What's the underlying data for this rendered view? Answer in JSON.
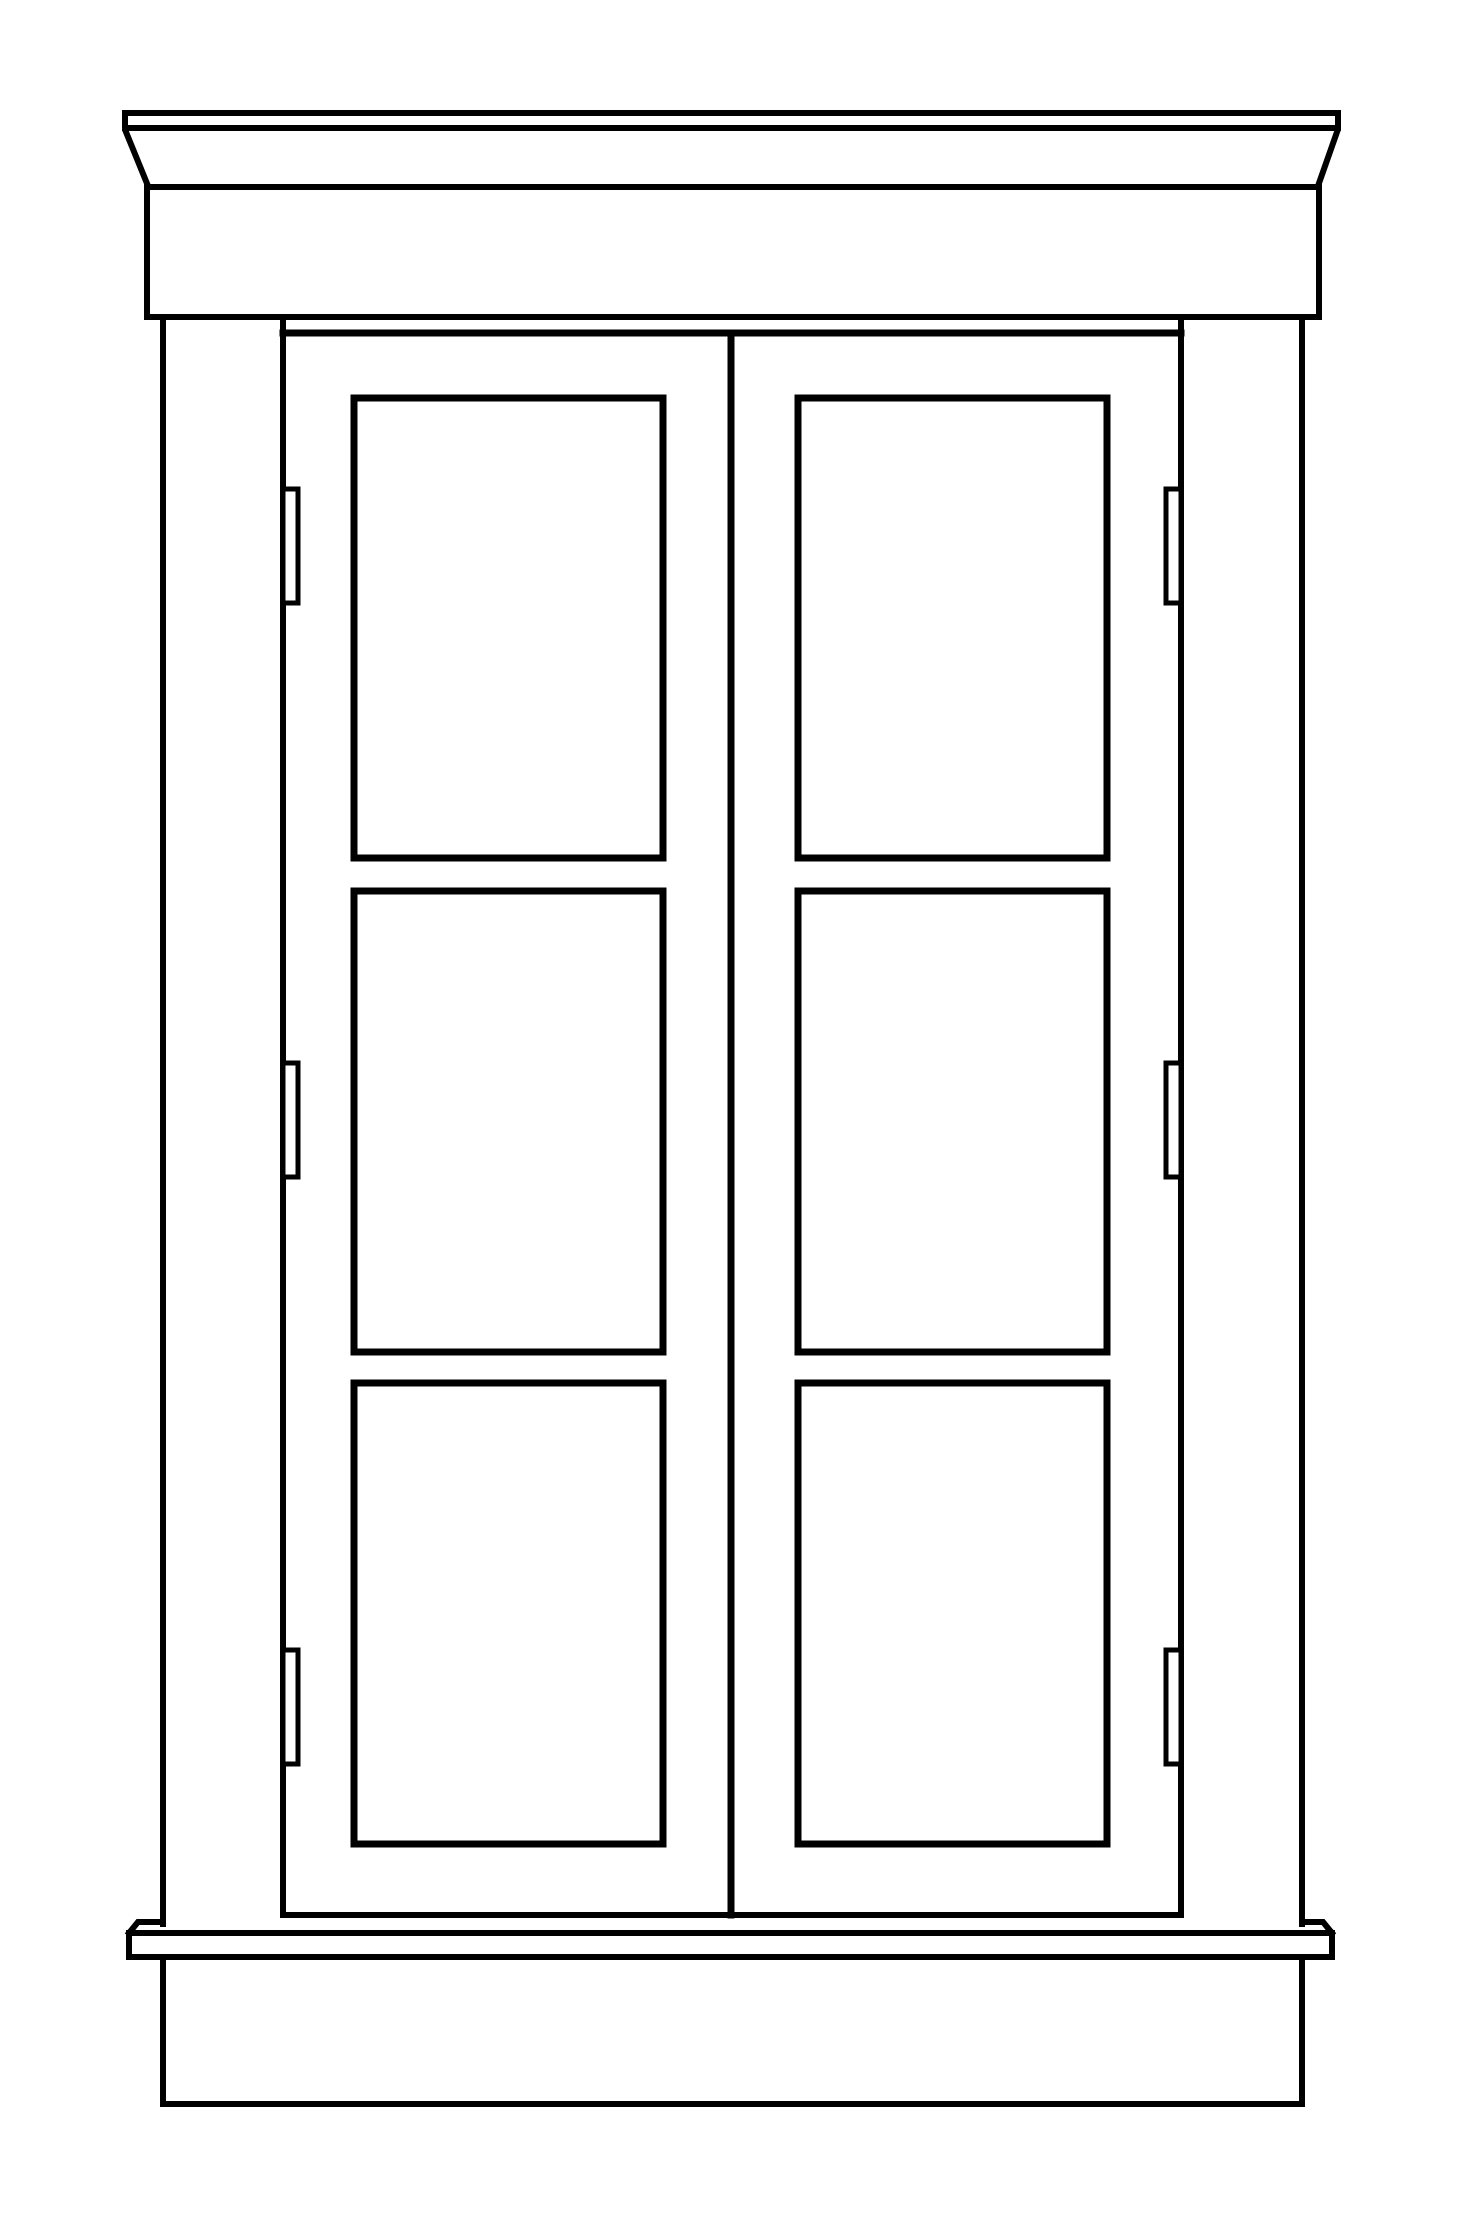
{
  "canvas": {
    "width": 1459,
    "height": 2229,
    "background_color": "#ffffff"
  },
  "drawing": {
    "subject": "cabinet-elevation-line-drawing",
    "line_color": "#000000",
    "default_stroke_width": 6,
    "shapes": [
      {
        "name": "crown-cap-board",
        "type": "rect",
        "x": 125,
        "y": 113,
        "w": 1213,
        "h": 15,
        "sw": 6,
        "fill": "#ffffff"
      },
      {
        "name": "crown-left-slant",
        "type": "line",
        "x1": 126,
        "y1": 132,
        "x2": 148,
        "y2": 186,
        "sw": 6
      },
      {
        "name": "crown-right-slant",
        "type": "line",
        "x1": 1337,
        "y1": 132,
        "x2": 1318,
        "y2": 186,
        "sw": 6
      },
      {
        "name": "crown-bottom-edge",
        "type": "line",
        "x1": 147,
        "y1": 187,
        "x2": 1319,
        "y2": 187,
        "sw": 6
      },
      {
        "name": "frieze-left-edge",
        "type": "line",
        "x1": 147,
        "y1": 187,
        "x2": 147,
        "y2": 317,
        "sw": 6
      },
      {
        "name": "frieze-right-edge",
        "type": "line",
        "x1": 1319,
        "y1": 187,
        "x2": 1319,
        "y2": 317,
        "sw": 6
      },
      {
        "name": "frieze-bottom-edge",
        "type": "line",
        "x1": 147,
        "y1": 317,
        "x2": 1319,
        "y2": 317,
        "sw": 6
      },
      {
        "name": "left-stile-outer-edge",
        "type": "line",
        "x1": 163,
        "y1": 317,
        "x2": 163,
        "y2": 1924,
        "sw": 6
      },
      {
        "name": "left-stile-inner-edge",
        "type": "line",
        "x1": 283,
        "y1": 317,
        "x2": 283,
        "y2": 1915,
        "sw": 6
      },
      {
        "name": "right-stile-inner-edge",
        "type": "line",
        "x1": 1181,
        "y1": 317,
        "x2": 1181,
        "y2": 1915,
        "sw": 6
      },
      {
        "name": "right-stile-outer-edge",
        "type": "line",
        "x1": 1302,
        "y1": 317,
        "x2": 1302,
        "y2": 1924,
        "sw": 6
      },
      {
        "name": "door-top-edge",
        "type": "line",
        "x1": 283,
        "y1": 333,
        "x2": 1181,
        "y2": 333,
        "sw": 7
      },
      {
        "name": "door-meeting-stile",
        "type": "line",
        "x1": 731,
        "y1": 333,
        "x2": 731,
        "y2": 1915,
        "sw": 7
      },
      {
        "name": "door-bottom-edge",
        "type": "line",
        "x1": 283,
        "y1": 1915,
        "x2": 1181,
        "y2": 1915,
        "sw": 6
      },
      {
        "name": "left-door-top-panel",
        "type": "rect",
        "x": 354,
        "y": 398,
        "w": 309,
        "h": 460,
        "sw": 7,
        "fill": "#ffffff"
      },
      {
        "name": "left-door-middle-panel",
        "type": "rect",
        "x": 354,
        "y": 891,
        "w": 309,
        "h": 461,
        "sw": 7,
        "fill": "#ffffff"
      },
      {
        "name": "left-door-bottom-panel",
        "type": "rect",
        "x": 354,
        "y": 1383,
        "w": 309,
        "h": 461,
        "sw": 7,
        "fill": "#ffffff"
      },
      {
        "name": "right-door-top-panel",
        "type": "rect",
        "x": 798,
        "y": 398,
        "w": 309,
        "h": 460,
        "sw": 7,
        "fill": "#ffffff"
      },
      {
        "name": "right-door-middle-panel",
        "type": "rect",
        "x": 798,
        "y": 891,
        "w": 309,
        "h": 461,
        "sw": 7,
        "fill": "#ffffff"
      },
      {
        "name": "right-door-bottom-panel",
        "type": "rect",
        "x": 798,
        "y": 1383,
        "w": 309,
        "h": 461,
        "sw": 7,
        "fill": "#ffffff"
      },
      {
        "name": "left-top-hinge",
        "type": "rect",
        "x": 283,
        "y": 489,
        "w": 15,
        "h": 114,
        "sw": 5,
        "fill": "#ffffff"
      },
      {
        "name": "left-middle-hinge",
        "type": "rect",
        "x": 283,
        "y": 1063,
        "w": 15,
        "h": 114,
        "sw": 5,
        "fill": "#ffffff"
      },
      {
        "name": "left-bottom-hinge",
        "type": "rect",
        "x": 283,
        "y": 1650,
        "w": 15,
        "h": 114,
        "sw": 5,
        "fill": "#ffffff"
      },
      {
        "name": "right-top-hinge",
        "type": "rect",
        "x": 1166,
        "y": 489,
        "w": 15,
        "h": 114,
        "sw": 5,
        "fill": "#ffffff"
      },
      {
        "name": "right-middle-hinge",
        "type": "rect",
        "x": 1166,
        "y": 1063,
        "w": 15,
        "h": 114,
        "sw": 5,
        "fill": "#ffffff"
      },
      {
        "name": "right-bottom-hinge",
        "type": "rect",
        "x": 1166,
        "y": 1650,
        "w": 15,
        "h": 114,
        "sw": 5,
        "fill": "#ffffff"
      },
      {
        "name": "sill-left-horn",
        "type": "path",
        "d": "M 163 1922 L 138 1922 L 129 1933",
        "sw": 6
      },
      {
        "name": "sill-right-horn",
        "type": "path",
        "d": "M 1302 1922 L 1323 1922 L 1332 1933",
        "sw": 6
      },
      {
        "name": "sill-top-edge",
        "type": "line",
        "x1": 129,
        "y1": 1933,
        "x2": 1332,
        "y2": 1933,
        "sw": 6
      },
      {
        "name": "sill-left-end",
        "type": "line",
        "x1": 129,
        "y1": 1933,
        "x2": 129,
        "y2": 1957,
        "sw": 6
      },
      {
        "name": "sill-right-end",
        "type": "line",
        "x1": 1332,
        "y1": 1933,
        "x2": 1332,
        "y2": 1957,
        "sw": 6
      },
      {
        "name": "sill-bottom-edge",
        "type": "line",
        "x1": 129,
        "y1": 1957,
        "x2": 1332,
        "y2": 1957,
        "sw": 6
      },
      {
        "name": "base-left-edge",
        "type": "line",
        "x1": 163,
        "y1": 1957,
        "x2": 163,
        "y2": 2104,
        "sw": 6
      },
      {
        "name": "base-right-edge",
        "type": "line",
        "x1": 1302,
        "y1": 1957,
        "x2": 1302,
        "y2": 2104,
        "sw": 6
      },
      {
        "name": "base-bottom-edge",
        "type": "line",
        "x1": 163,
        "y1": 2104,
        "x2": 1302,
        "y2": 2104,
        "sw": 6
      }
    ]
  }
}
